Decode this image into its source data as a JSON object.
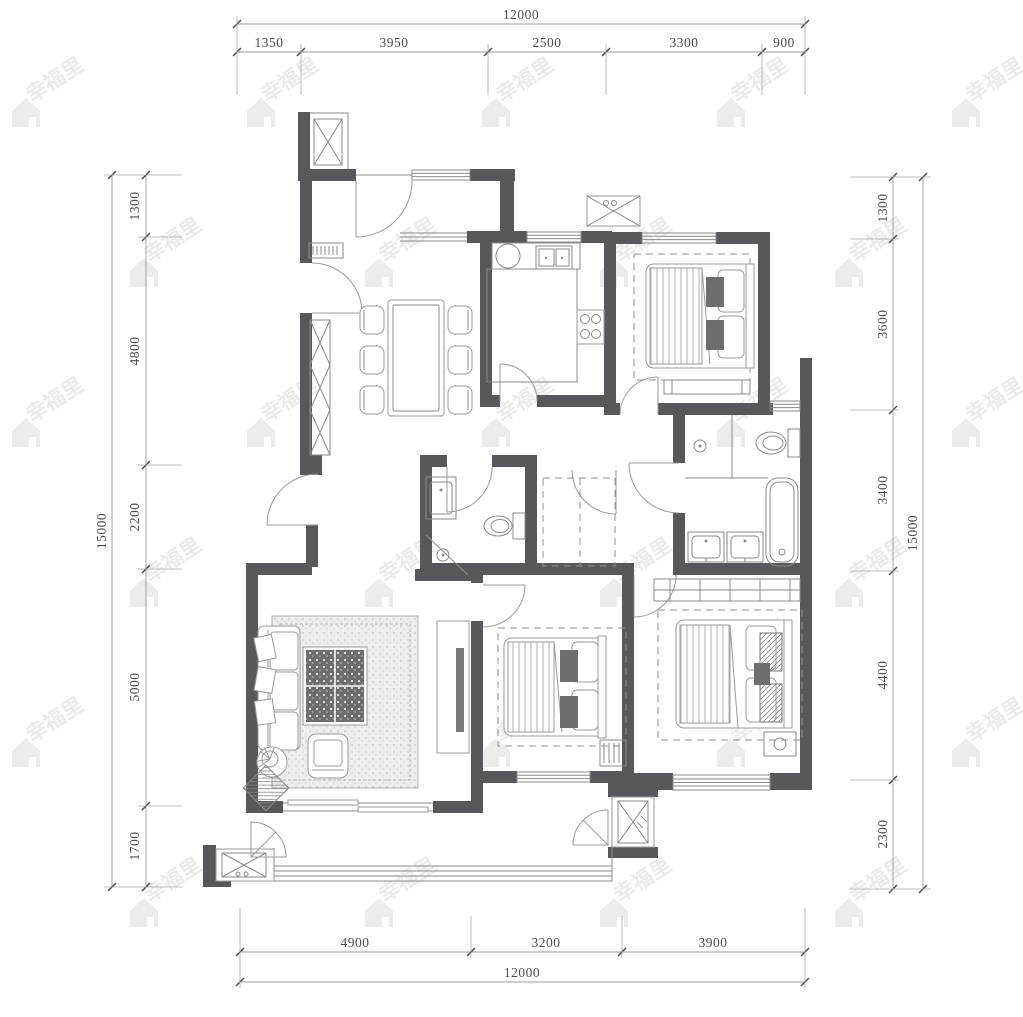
{
  "watermark": {
    "text": "幸福里",
    "icon": "house-icon",
    "color": "#ececec"
  },
  "plan": {
    "wall_color": "#58585c",
    "line_color": "#8a8a8a"
  },
  "dimensions": {
    "top": {
      "total": "12000",
      "segments": [
        "1350",
        "3950",
        "2500",
        "3300",
        "900"
      ]
    },
    "bottom": {
      "total": "12000",
      "segments": [
        "4900",
        "3200",
        "3900"
      ]
    },
    "left": {
      "total": "15000",
      "segments": [
        "1300",
        "4800",
        "2200",
        "5000",
        "1700"
      ]
    },
    "right": {
      "total": "15000",
      "segments": [
        "1300",
        "3600",
        "3400",
        "4400",
        "2300"
      ]
    }
  }
}
